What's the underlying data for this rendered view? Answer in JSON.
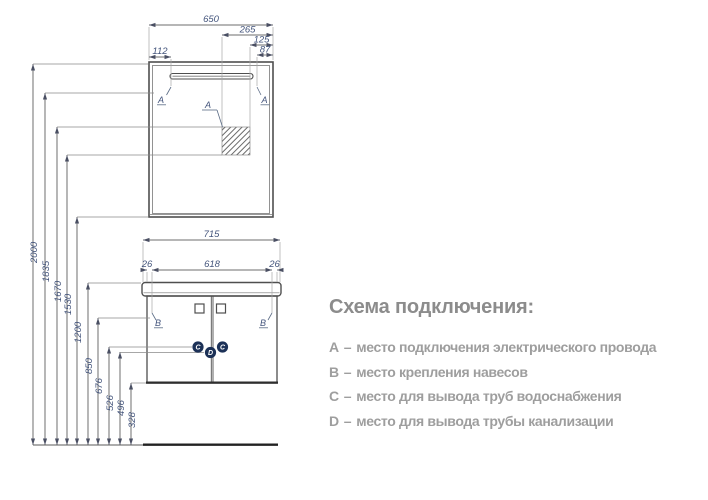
{
  "colors": {
    "line": "#4f4f4f",
    "thin_line": "#a8a8a8",
    "dim_line": "#6e6e6e",
    "dim_text": "#44557c",
    "marker_circle": "#1c3157",
    "marker_letter": "#ffffff",
    "legend_title": "#8c8c8c",
    "legend_text": "#9e9e9e",
    "background": "#ffffff"
  },
  "drawing": {
    "top_dims": {
      "overall_width": "650",
      "outlet_from_right": "265",
      "outlet_right_edge": "125",
      "lamp_right": "87",
      "lamp_left": "112"
    },
    "vanity_dims": {
      "overall_width": "715",
      "left_offset": "26",
      "center_span": "618",
      "right_offset": "26"
    },
    "height_dims": [
      "2000",
      "1835",
      "1670",
      "1530",
      "1200",
      "850",
      "676",
      "526",
      "496",
      "328"
    ],
    "marks": {
      "mirror_left": "A",
      "mirror_right": "A",
      "outlet_zone": "A",
      "vanity_left": "B",
      "vanity_right": "B",
      "water_left": "C",
      "drain": "D",
      "water_right": "C"
    }
  },
  "legend": {
    "title": "Схема подключения:",
    "separator": "–",
    "items": [
      {
        "letter": "A",
        "text": "место подключения электрического провода"
      },
      {
        "letter": "B",
        "text": "место крепления навесов"
      },
      {
        "letter": "C",
        "text": "место для вывода труб водоснабжения"
      },
      {
        "letter": "D",
        "text": "место для вывода трубы канализации"
      }
    ]
  }
}
